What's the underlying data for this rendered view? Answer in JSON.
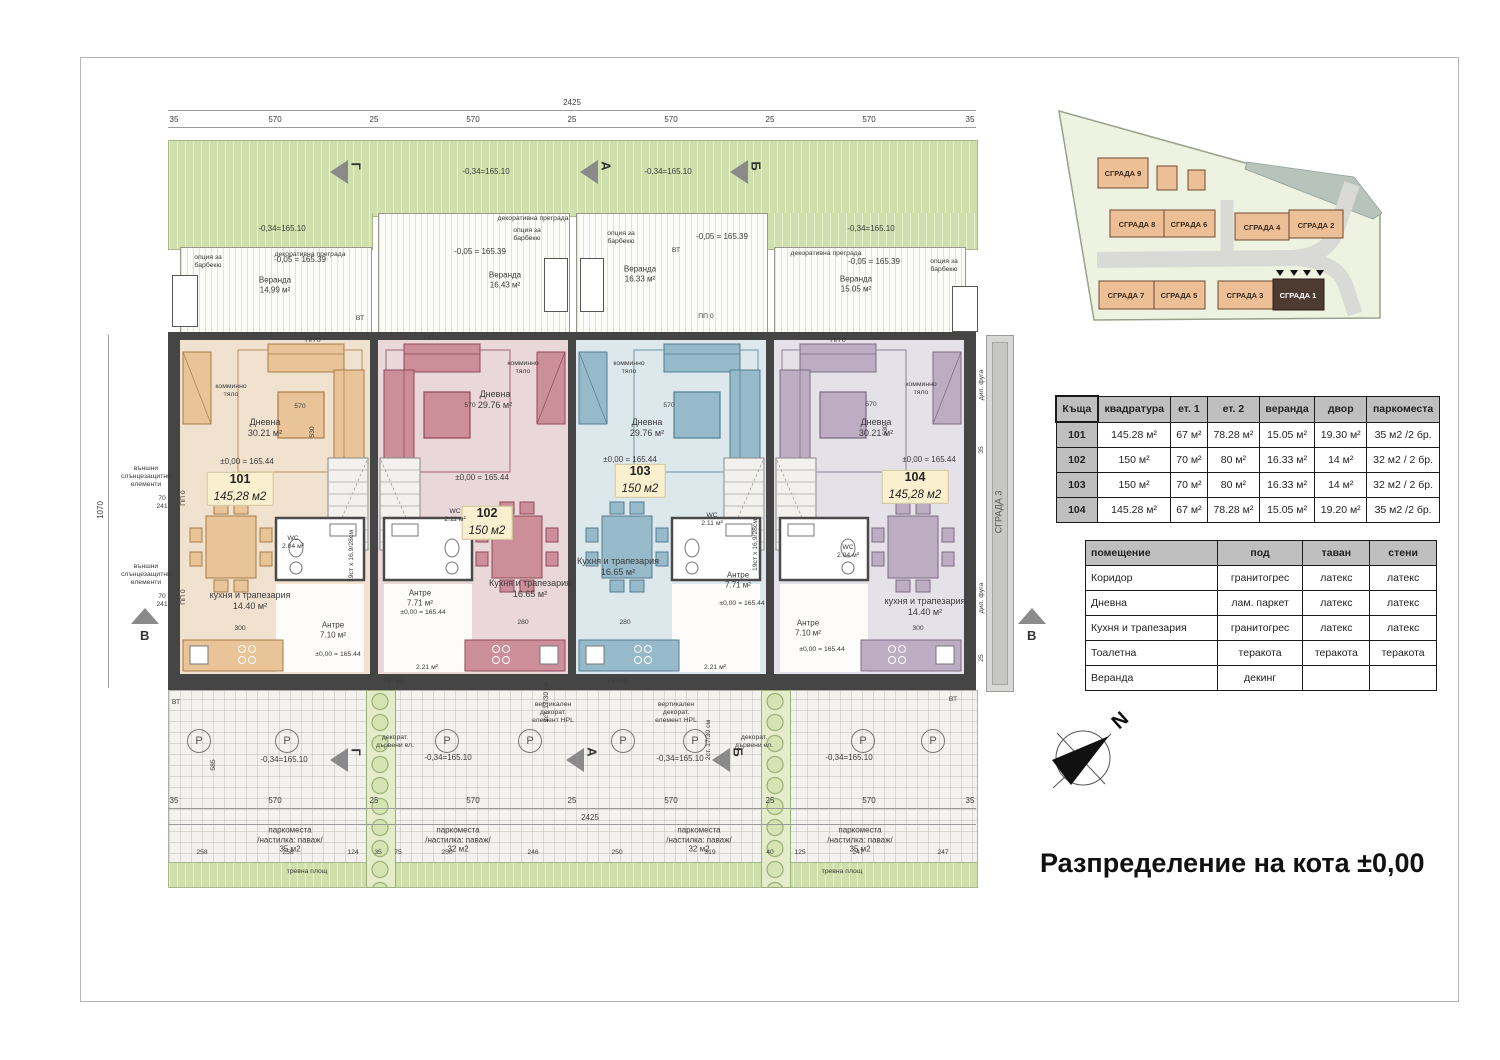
{
  "title": "Разпределение на кота ±0,00",
  "compass": {
    "n": "N"
  },
  "colors": {
    "unit101_fill": "#f0e2cf",
    "unit102_fill": "#e9d7d9",
    "unit103_fill": "#dde8ec",
    "unit104_fill": "#e5e1e8",
    "lawn": "#cfe0ad",
    "wall": "#454545",
    "site_building": "#edbf97",
    "site_highlight": "#4d3a31",
    "tag_bg": "#faf0cf"
  },
  "units": [
    {
      "id": "101",
      "area": "145,28 м2",
      "living": "Дневна\n30.21 м²",
      "level": "±0,00 = 165.44",
      "kitchen": "кухня и трапезария\n14.40 м²",
      "hall": "Антре\n7.10 м²",
      "wc": "WC\n2.04 м²",
      "veranda": "Веранда\n14,99 м²",
      "veranda_level": "-0,05 = 165.39"
    },
    {
      "id": "102",
      "area": "150 м2",
      "living": "Дневна\n29.76 м²",
      "level": "±0,00 = 165.44",
      "kitchen": "Кухня и трапезария\n16.65 м²",
      "hall": "Антре\n7.71 м²",
      "wc": "WC\n2.11 м²",
      "veranda": "Веранда\n16,43 м²",
      "veranda_level": "-0,05 = 165.39",
      "storage": "2.21 м²"
    },
    {
      "id": "103",
      "area": "150 м2",
      "living": "Дневна\n29.76 м²",
      "level": "±0,00 = 165.44",
      "kitchen": "Кухня и трапезария\n16.65 м²",
      "hall": "Антре\n7.71 м²",
      "wc": "WC\n2.11 м²",
      "veranda": "Веранда\n16.33 м²",
      "veranda_level": "-0,05 = 165.39",
      "storage": "2.21 м²"
    },
    {
      "id": "104",
      "area": "145,28 м2",
      "living": "Дневна\n30.21 м²",
      "level": "±0,00 = 165.44",
      "kitchen": "кухня и трапезария\n14.40 м²",
      "hall": "Антре\n7.10 м²",
      "wc": "WC\n2.04 м²",
      "veranda": "Веранда\n15.05 м²",
      "veranda_level": "-0,05 = 165.39"
    }
  ],
  "ann": {
    "lawn_level": "-0,34=165.10",
    "dec_partition": "декоративна преграда",
    "bbq_option": "опция за\nбарбекю",
    "chimney": "комминно\nтяло",
    "sun_elements": "външни\nслънцезащитни\nелементи",
    "seventy": "70\n241",
    "vt": "ВТ",
    "pp0": "ПП 0",
    "pp90": "ПП 90",
    "parking_35": "паркоместа\n/настилка: паваж/\n35 м2",
    "parking_32": "паркоместа\n/настилка: паваж/\n32 м2",
    "lawn_area": "тревна площ",
    "hpl": "вертикален\nдекорат.\nелемент HPL",
    "wood_el": "декорат.\nдървени ел.",
    "steps_note": "2ст. 17/30 см",
    "stair_note": "19ст х 16,9/28см",
    "grada3": "СГРАДА 3",
    "dilfuga": "дил. фуга",
    "p": "P"
  },
  "dims": {
    "total": "2425",
    "side": "1070",
    "segs": [
      "35",
      "570",
      "25",
      "570",
      "25",
      "570",
      "25",
      "570",
      "35"
    ],
    "sub": [
      "258",
      "258",
      "124",
      "35",
      "75",
      "250",
      "246",
      "250",
      "319",
      "40",
      "125",
      "247",
      "247"
    ],
    "d570": "570",
    "d530": "530",
    "d300": "300",
    "d280": "280",
    "d585": "585",
    "d35": "35",
    "d25": "25"
  },
  "sections": {
    "a": "А",
    "b": "Б",
    "v": "В",
    "g": "Г"
  },
  "site_plan": {
    "buildings": [
      {
        "name": "СГРАДА 9"
      },
      {
        "name": "СГРАДА 8"
      },
      {
        "name": "СГРАДА 6"
      },
      {
        "name": "СГРАДА 4"
      },
      {
        "name": "СГРАДА 2"
      },
      {
        "name": "СГРАДА 7"
      },
      {
        "name": "СГРАДА 5"
      },
      {
        "name": "СГРАДА 3"
      },
      {
        "name": "СГРАДА 1"
      }
    ],
    "highlighted": "СГРАДА 1"
  },
  "units_table": {
    "headers": [
      "Къща",
      "квадратура",
      "ет. 1",
      "ет. 2",
      "веранда",
      "двор",
      "паркоместа"
    ],
    "rows": [
      [
        "101",
        "145.28 м²",
        "67 м²",
        "78.28 м²",
        "15.05 м²",
        "19.30 м²",
        "35 м2 /2 бр."
      ],
      [
        "102",
        "150 м²",
        "70 м²",
        "80 м²",
        "16.33 м²",
        "14 м²",
        "32 м2 / 2 бр."
      ],
      [
        "103",
        "150 м²",
        "70 м²",
        "80 м²",
        "16.33 м²",
        "14 м²",
        "32 м2 / 2 бр."
      ],
      [
        "104",
        "145.28 м²",
        "67 м²",
        "78.28 м²",
        "15.05 м²",
        "19.20 м²",
        "35 м2 /2 бр."
      ]
    ]
  },
  "finishes_table": {
    "headers": [
      "помещение",
      "под",
      "таван",
      "стени"
    ],
    "rows": [
      [
        "Коридор",
        "гранитогрес",
        "латекс",
        "латекс"
      ],
      [
        "Дневна",
        "лам. паркет",
        "латекс",
        "латекс"
      ],
      [
        "Кухня и трапезария",
        "гранитогрес",
        "латекс",
        "латекс"
      ],
      [
        "Тоалетна",
        "теракота",
        "теракота",
        "теракота"
      ],
      [
        "Веранда",
        "декинг",
        "",
        ""
      ]
    ]
  }
}
